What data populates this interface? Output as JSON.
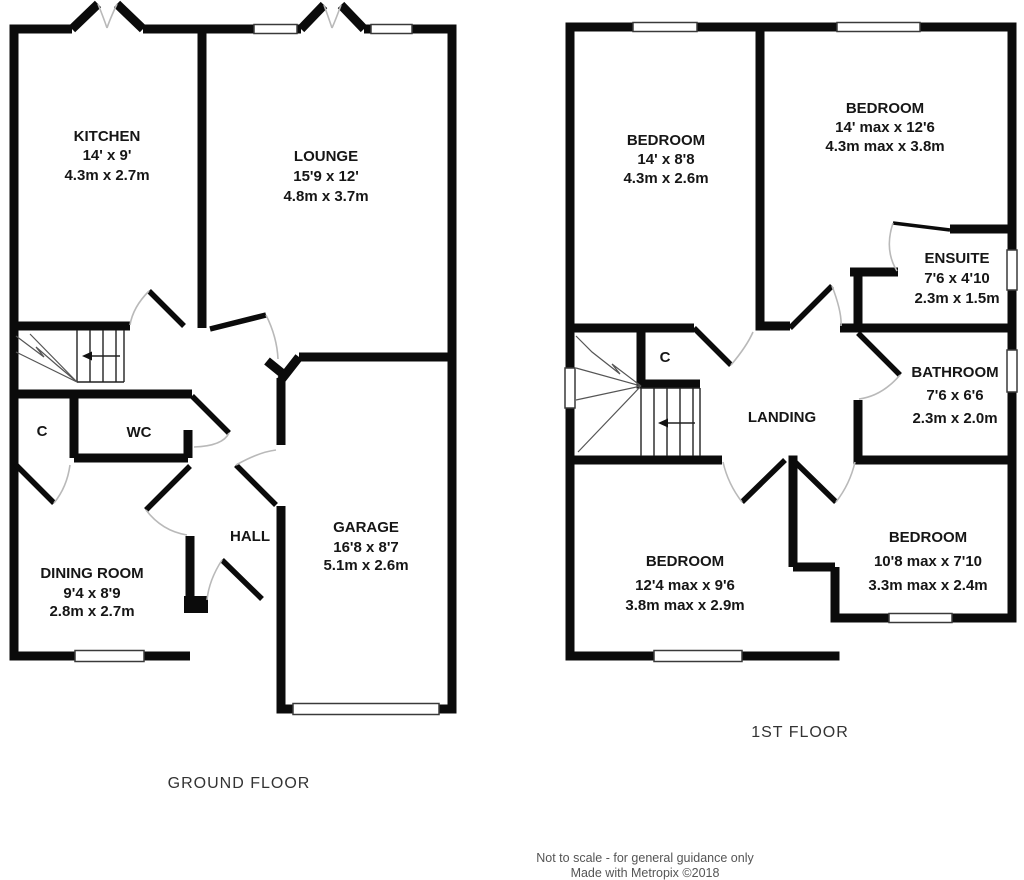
{
  "ground_floor": {
    "title": "GROUND FLOOR",
    "rooms": {
      "kitchen": {
        "name": "KITCHEN",
        "dim_ft": "14' x 9'",
        "dim_m": "4.3m x 2.7m"
      },
      "lounge": {
        "name": "LOUNGE",
        "dim_ft": "15'9 x 12'",
        "dim_m": "4.8m x 3.7m"
      },
      "cupboard": {
        "name": "C"
      },
      "wc": {
        "name": "WC"
      },
      "dining_room": {
        "name": "DINING ROOM",
        "dim_ft": "9'4 x 8'9",
        "dim_m": "2.8m x 2.7m"
      },
      "hall": {
        "name": "HALL"
      },
      "garage": {
        "name": "GARAGE",
        "dim_ft": "16'8 x 8'7",
        "dim_m": "5.1m x 2.6m"
      }
    }
  },
  "first_floor": {
    "title": "1ST FLOOR",
    "rooms": {
      "bedroom_front_left": {
        "name": "BEDROOM",
        "dim_ft": "14' x 8'8",
        "dim_m": "4.3m x 2.6m"
      },
      "bedroom_front_right": {
        "name": "BEDROOM",
        "dim_ft": "14' max x 12'6",
        "dim_m": "4.3m max x 3.8m"
      },
      "ensuite": {
        "name": "ENSUITE",
        "dim_ft": "7'6 x 4'10",
        "dim_m": "2.3m x 1.5m"
      },
      "cupboard": {
        "name": "C"
      },
      "bathroom": {
        "name": "BATHROOM",
        "dim_ft": "7'6 x 6'6",
        "dim_m": "2.3m x 2.0m"
      },
      "landing": {
        "name": "LANDING"
      },
      "bedroom_back_left": {
        "name": "BEDROOM",
        "dim_ft": "12'4 max x 9'6",
        "dim_m": "3.8m max x 2.9m"
      },
      "bedroom_back_right": {
        "name": "BEDROOM",
        "dim_ft": "10'8 max x 7'10",
        "dim_m": "3.3m max x 2.4m"
      }
    }
  },
  "footer": {
    "line1": "Not to scale - for general guidance only",
    "line2": "Made with Metropix ©2018"
  }
}
